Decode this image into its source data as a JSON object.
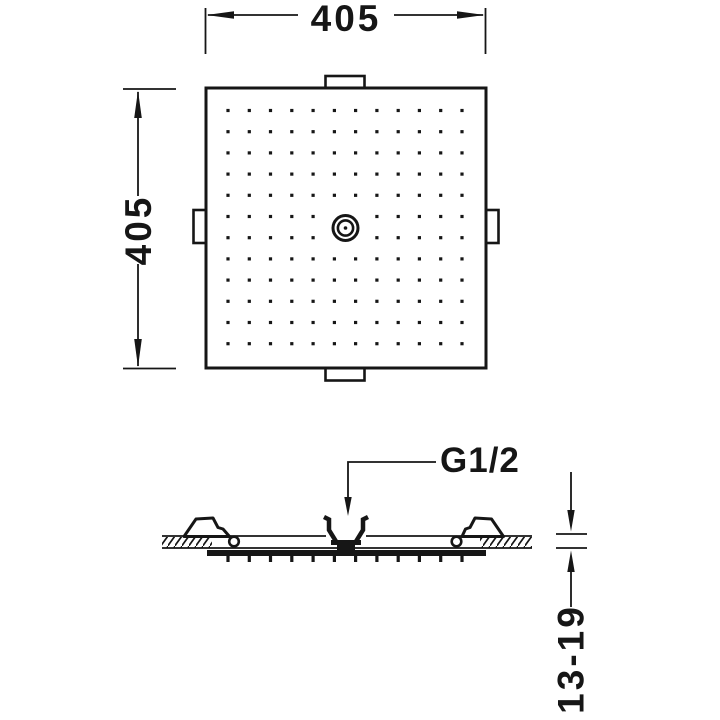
{
  "drawing": {
    "type": "technical-dimension-drawing",
    "top_view": {
      "width_label": "405",
      "height_label": "405",
      "nozzle_grid": {
        "rows": 12,
        "cols": 12
      }
    },
    "side_view": {
      "thread_label": "G1/2",
      "depth_label": "13-19",
      "nozzle_tick_count": 12
    },
    "colors": {
      "line": "#161616",
      "background": "#ffffff"
    }
  }
}
